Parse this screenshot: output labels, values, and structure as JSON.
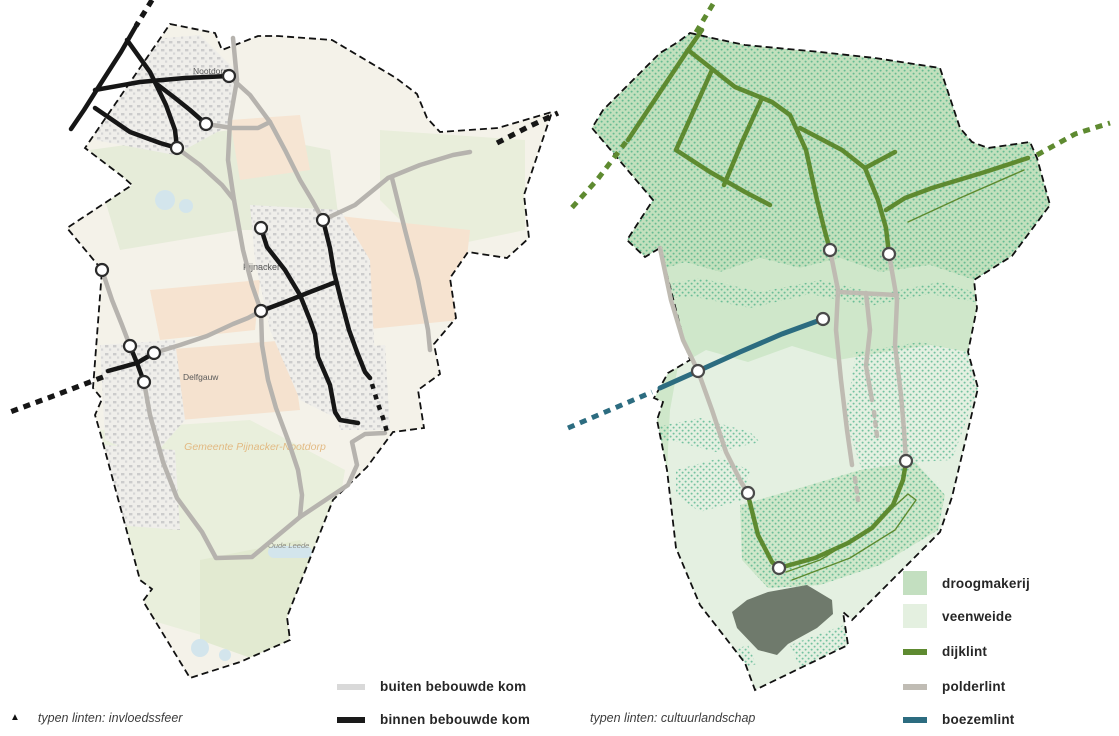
{
  "left_panel": {
    "caption_marker": "▲",
    "caption_text": "typen linten: invloedssfeer",
    "legend": {
      "items": [
        {
          "label": "buiten bebouwde kom",
          "color": "#d9d9d9"
        },
        {
          "label": "binnen bebouwde kom",
          "color": "#1a1a1a"
        }
      ]
    },
    "map_labels": {
      "nootdorp": "Nootdorp",
      "pijnacker": "Pijnacker",
      "delfgauw": "Delfgauw",
      "oude_leede": "Oude Leede",
      "watermark": "Gemeente Pijnacker-Nootdorp"
    },
    "line_colors": {
      "binnen": "#161616",
      "buiten": "#b6b3ae"
    }
  },
  "right_panel": {
    "caption_text": "typen linten: cultuurlandschap",
    "legend": {
      "items": [
        {
          "label": "droogmakerij",
          "color": "#c3dfc0"
        },
        {
          "label": "veenweide",
          "color": "#e4f0e0"
        },
        {
          "label": "dijklint",
          "color": "#5e8a30"
        },
        {
          "label": "polderlint",
          "color": "#c0bcb4"
        },
        {
          "label": "boezemlint",
          "color": "#2c6c80"
        }
      ]
    }
  }
}
